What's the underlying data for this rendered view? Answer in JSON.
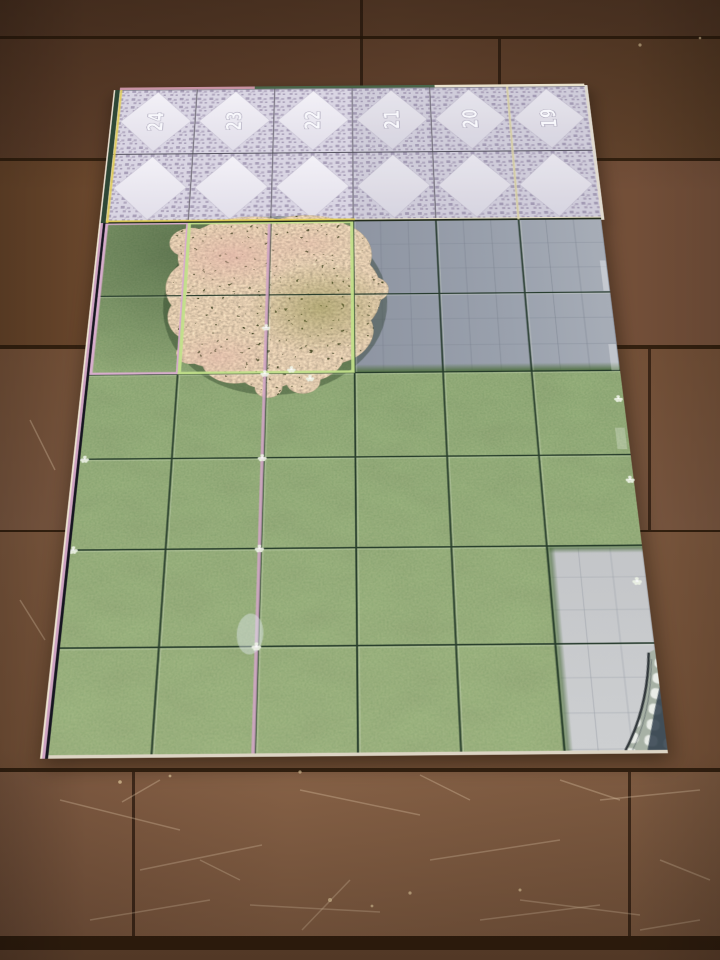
{
  "battle_map": {
    "tile_band": {
      "numbers": [
        "24",
        "23",
        "22",
        "21",
        "20",
        "19"
      ]
    },
    "colors": {
      "grass": "#5d7c49",
      "tile_floor": "#ece9f2",
      "tile_mosaic": "#a89fb8",
      "pavement_upper": "#949ba8",
      "pavement_lower": "#c6c8cb",
      "panel_edge_pink": "#d2a6c6",
      "panel_edge_lime": "#c2e08a",
      "panel_edge_yellow": "#e3cf56",
      "bush_flowers": "#d9b49c",
      "bush_leaves": "#8b8a55",
      "grid_line": "#1f3526"
    }
  },
  "background": {
    "colors": {
      "wood": "#6e4b33",
      "wood_gap": "#2e1d12"
    }
  }
}
